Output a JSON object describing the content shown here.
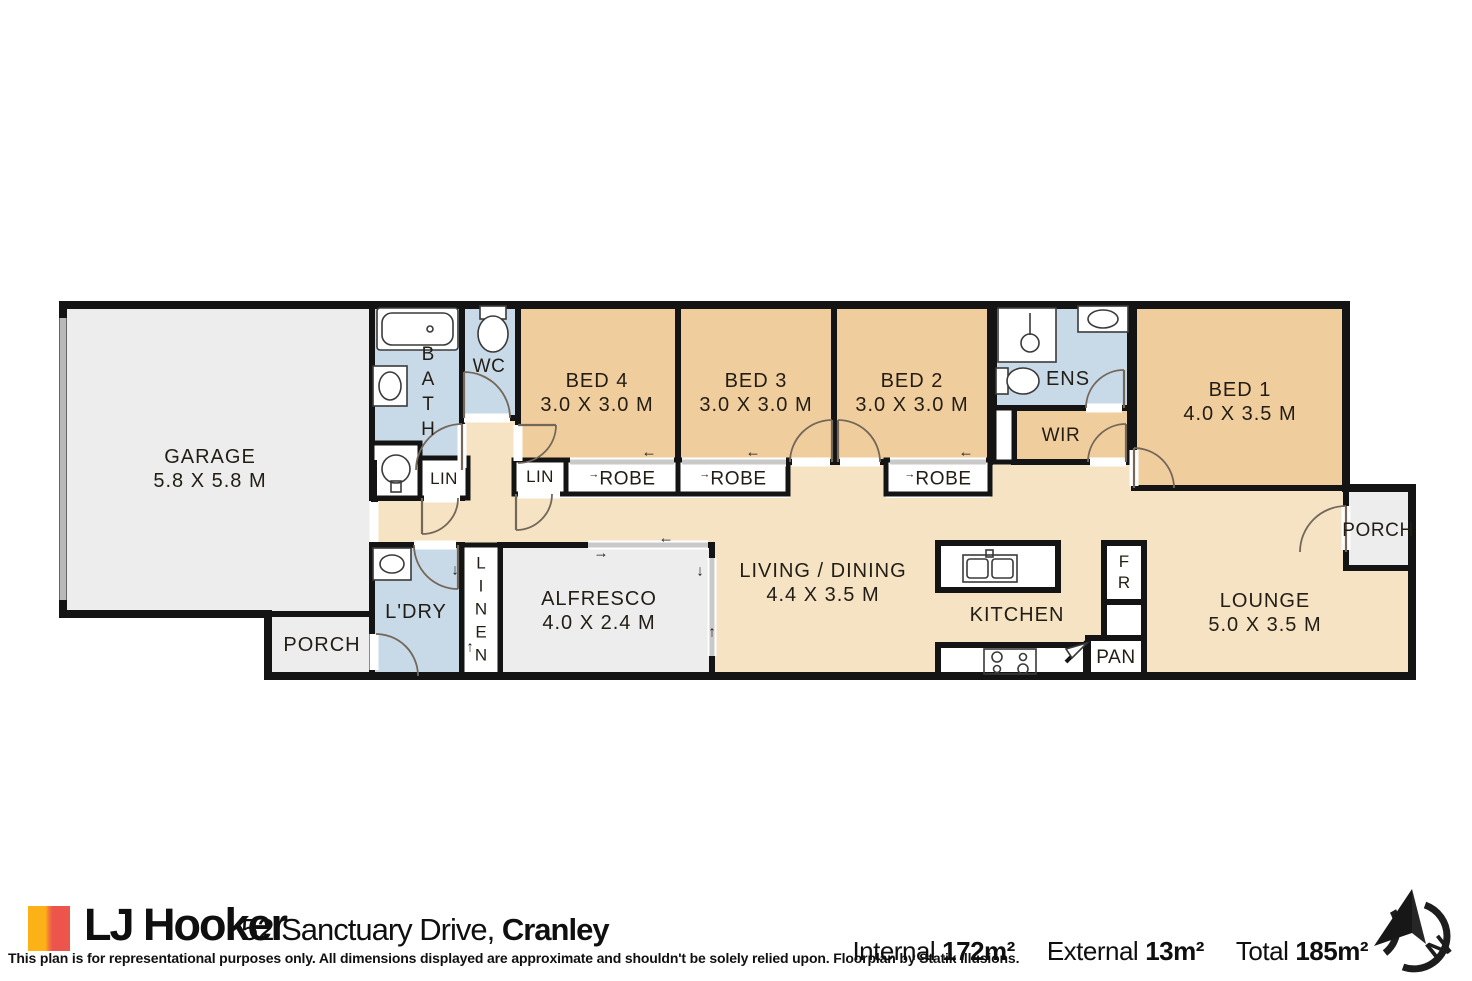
{
  "rooms": {
    "garage": {
      "label": "GARAGE",
      "dims": "5.8 X 5.8 M"
    },
    "bed4": {
      "label": "BED 4",
      "dims": "3.0 X 3.0 M"
    },
    "bed3": {
      "label": "BED 3",
      "dims": "3.0 X 3.0 M"
    },
    "bed2": {
      "label": "BED 2",
      "dims": "3.0 X 3.0 M"
    },
    "bed1": {
      "label": "BED 1",
      "dims": "4.0 X 3.5 M"
    },
    "living": {
      "label": "LIVING / DINING",
      "dims": "4.4 X 3.5 M"
    },
    "lounge": {
      "label": "LOUNGE",
      "dims": "5.0 X 3.5 M"
    },
    "alfresco": {
      "label": "ALFRESCO",
      "dims": "4.0 X 2.4 M"
    },
    "bath": {
      "label": "BATH"
    },
    "wc": {
      "label": "WC"
    },
    "ens": {
      "label": "ENS"
    },
    "wir": {
      "label": "WIR"
    },
    "kitchen": {
      "label": "KITCHEN"
    },
    "fr": {
      "label": "FR"
    },
    "pan": {
      "label": "PAN"
    },
    "ldry": {
      "label": "L'DRY"
    },
    "linen": {
      "label": "LINEN"
    }
  },
  "lins": [
    "LIN",
    "LIN"
  ],
  "robes": [
    "ROBE",
    "ROBE",
    "ROBE"
  ],
  "porches": [
    "PORCH",
    "PORCH"
  ],
  "icons": {
    "left": "←",
    "right": "→",
    "up": "↑",
    "down": "↓"
  },
  "footer": {
    "brand": "LJ Hooker",
    "address_street": "52 Sanctuary Drive,",
    "address_suburb": "Cranley",
    "disclaimer": "This plan is for representational purposes only. All dimensions displayed are approximate and shouldn't be solely relied upon. Floorplan by Statik Illusions.",
    "stats": [
      {
        "label": "Internal",
        "value": "172m²"
      },
      {
        "label": "External",
        "value": "13m²"
      },
      {
        "label": "Total",
        "value": "185m²"
      }
    ],
    "compass_letter": "N"
  }
}
